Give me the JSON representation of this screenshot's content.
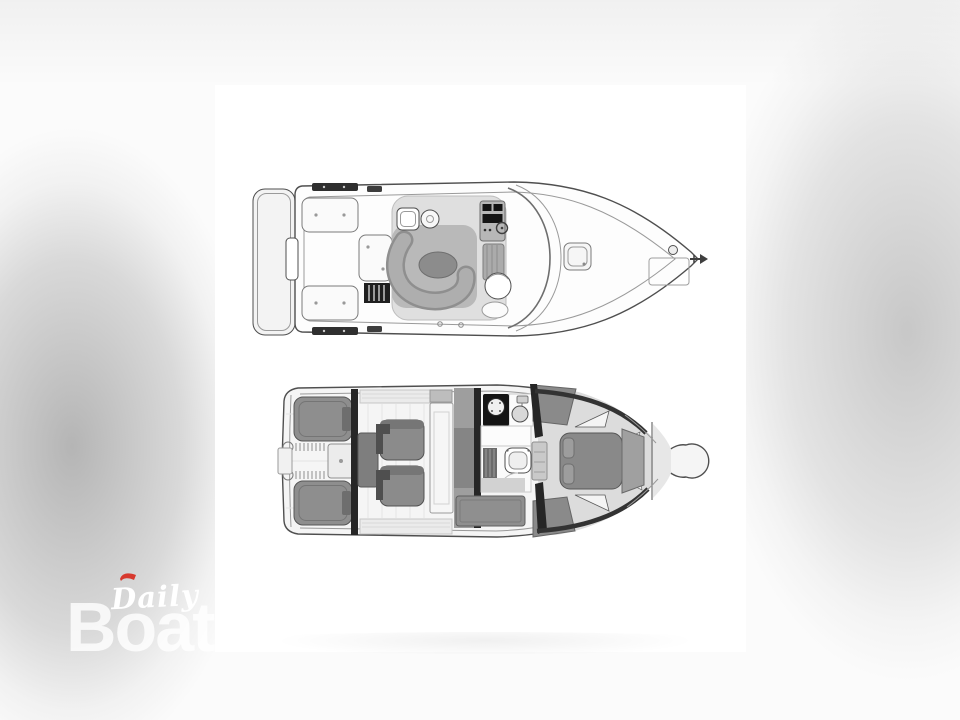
{
  "canvas": {
    "width": 960,
    "height": 720
  },
  "watermark": {
    "script_text": "Daily",
    "ghost_text": "Boats"
  },
  "colors": {
    "backdrop": "#fbfbfb",
    "panel": "#ffffff",
    "outline": "#4f4f4f",
    "line_soft": "#9a9a9a",
    "hull_fill": "#fdfdfd",
    "deck_gray": "#dfdfdf",
    "platform_gray": "#b9b9b9",
    "settee_gray": "#aeaeae",
    "table_gray": "#8c8c8c",
    "furniture_gray": "#8b8b8b",
    "armrest_dark": "#4f4f4f",
    "bulkhead_dark": "#262626",
    "appliance_black": "#141414",
    "brand_red": "#d7392e",
    "watermark_white": "#ffffff"
  },
  "diagram": {
    "type": "boat-floor-plan",
    "views": [
      {
        "id": "main-deck",
        "features": [
          "swim-platform",
          "transom-door",
          "cockpit-hatches",
          "gunwale-treads",
          "flybridge-ladder",
          "wet-bar-sink",
          "grill",
          "c-shaped-settee",
          "oval-table",
          "helm-console",
          "steering-wheel",
          "companion-bench",
          "helm-seat",
          "windshield",
          "foredeck-hatch",
          "anchor-locker",
          "windlass",
          "bow-pulpit-anchor"
        ]
      },
      {
        "id": "lower-deck",
        "features": [
          "twin-engines",
          "exhaust-manifolds",
          "generator",
          "engine-room-bulkhead",
          "salon-cabinet",
          "club-chairs",
          "sideboard-table",
          "galley-bulkhead",
          "stove-burner",
          "galley-sink",
          "head-toilet",
          "louvered-locker",
          "storage-cabinet",
          "companionway-steps",
          "v-berth-island-bed",
          "bed-footboard",
          "trim-triangles",
          "bow-locker-bulb"
        ]
      }
    ]
  }
}
